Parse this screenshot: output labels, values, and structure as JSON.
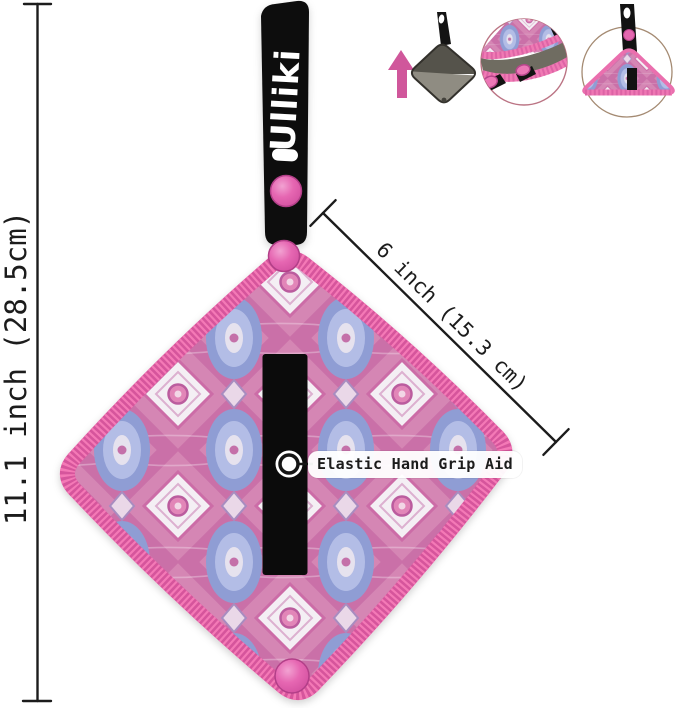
{
  "brand": {
    "logo_text": "Ulliki"
  },
  "dimensions": {
    "height_label": "11.1 inch (28.5cm)",
    "diagonal_label": "6 inch (15.3 cm)"
  },
  "callout": {
    "grip_label": "Elastic Hand Grip Aid"
  },
  "colors": {
    "edge_pink": "#ee6fae",
    "snap_pink": "#e667b2",
    "fabric_pink": "#d586b4",
    "fabric_periwinkle": "#8f9dd4",
    "fabric_white": "#f4eff4",
    "strap_black": "#0d0d0d",
    "back_gray_dark": "#55534b",
    "back_gray_light": "#8f8c82",
    "arrow_pink": "#d0579b",
    "dimension_line": "#1c1c1c"
  }
}
